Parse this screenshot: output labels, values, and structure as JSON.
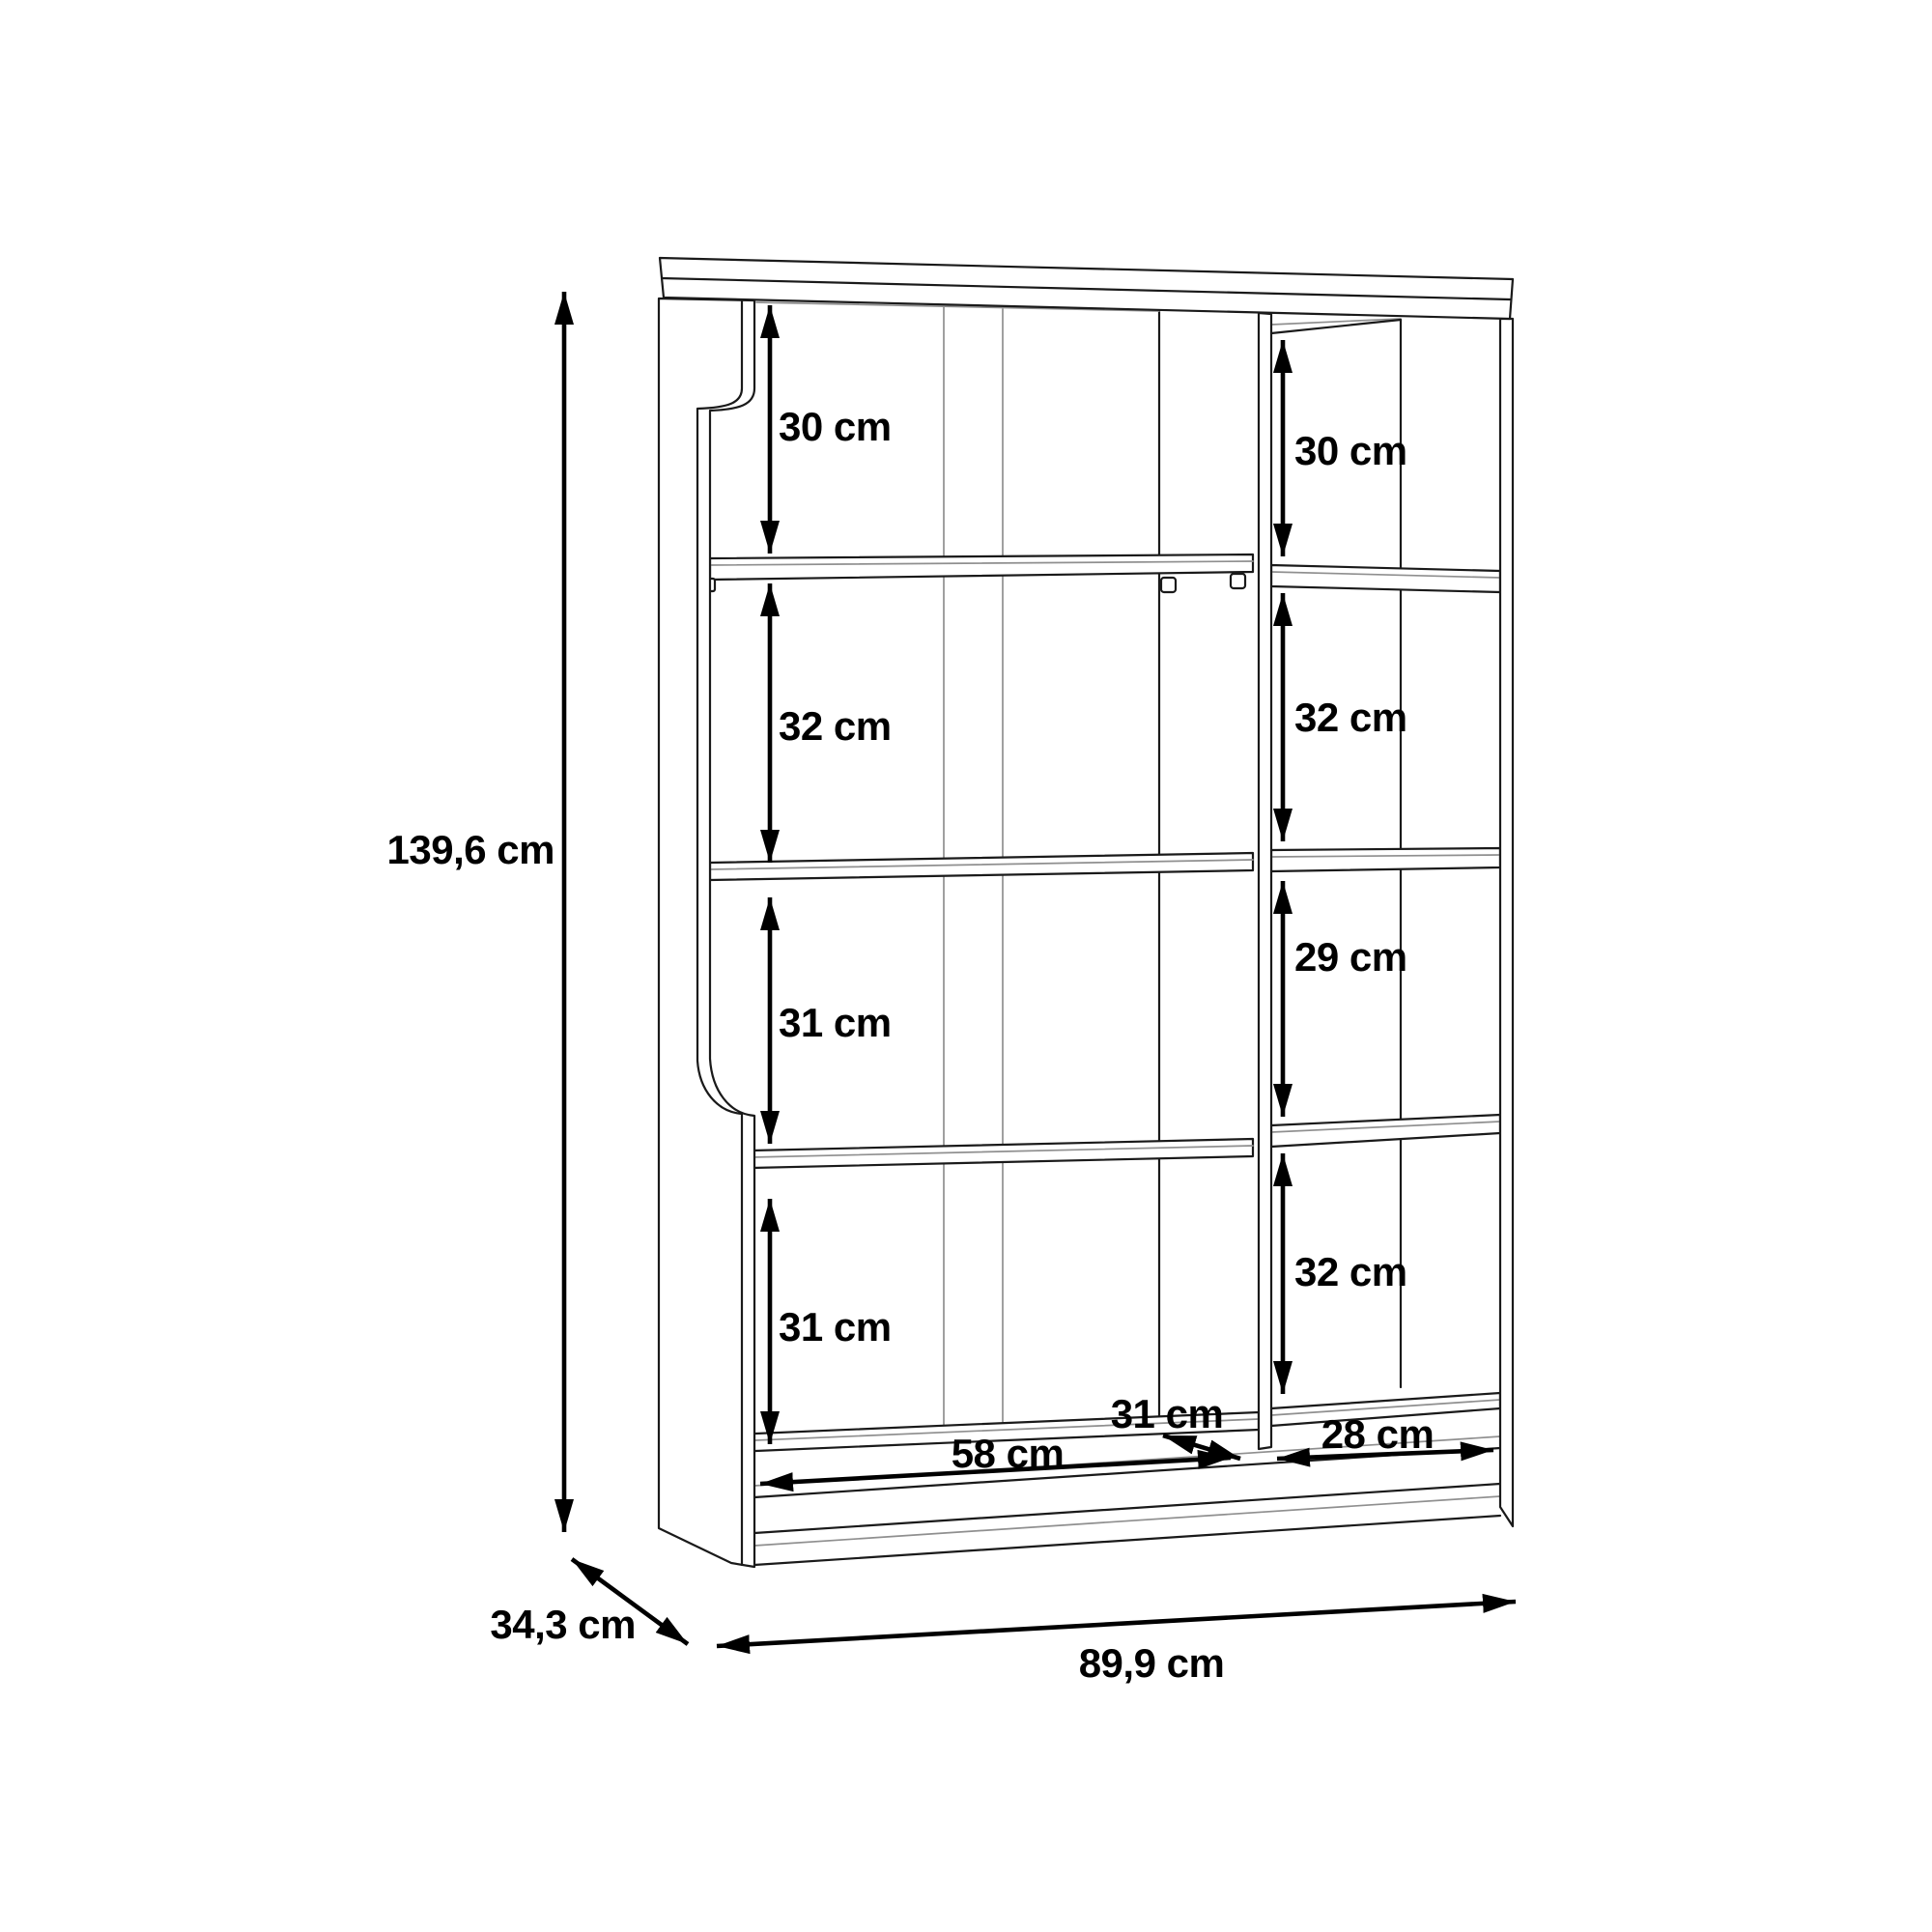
{
  "drawing": {
    "type": "furniture-dimension-diagram",
    "unit": "cm",
    "background_color": "#ffffff",
    "line_color": "#1a1a1a",
    "dimension_color": "#000000",
    "overall": {
      "height": "139,6 cm",
      "depth": "34,3 cm",
      "width": "89,9 cm"
    },
    "left_sections": [
      "30 cm",
      "32 cm",
      "31 cm",
      "31 cm"
    ],
    "right_sections": [
      "30 cm",
      "32 cm",
      "29 cm",
      "32 cm"
    ],
    "base": {
      "left_width": "58 cm",
      "divider_depth": "31 cm",
      "right_width": "28 cm"
    }
  }
}
